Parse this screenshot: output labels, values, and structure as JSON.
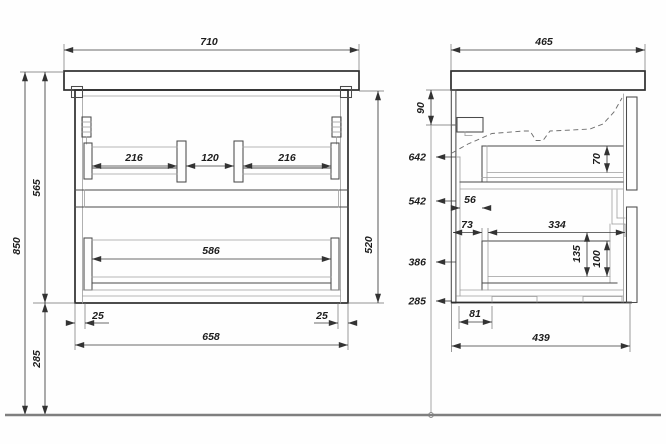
{
  "drawing": {
    "kind": "vanity-cabinet-technical-drawing",
    "colors": {
      "background": "#fefefe",
      "object_line": "#2d2d2d",
      "detail_line": "#9d9d9d",
      "dimension_line": "#3a3a3a",
      "floor_line": "#7f7f7f",
      "text": "#1c1c1c"
    },
    "front_view": {
      "top_width": "710",
      "overall_height": "850",
      "cabinet_height": "565",
      "floor_clearance": "285",
      "body_height": "520",
      "upper_rail_left": "216",
      "upper_rail_gap": "120",
      "upper_rail_right": "216",
      "lower_rail_width": "586",
      "side_inset_left": "25",
      "side_inset_right": "25",
      "body_width": "658"
    },
    "side_view": {
      "top_depth": "465",
      "bracket_drop": "90",
      "level_a": "642",
      "level_b": "542",
      "level_c": "386",
      "level_d": "285",
      "upper_drawer_depth": "70",
      "upper_back_gap": "56",
      "lower_back_gap": "73",
      "lower_drawer_length": "334",
      "lower_drawer_depth": "135",
      "lower_drawer_inner_depth": "100",
      "foot_inset": "81",
      "bottom_depth": "439"
    }
  }
}
